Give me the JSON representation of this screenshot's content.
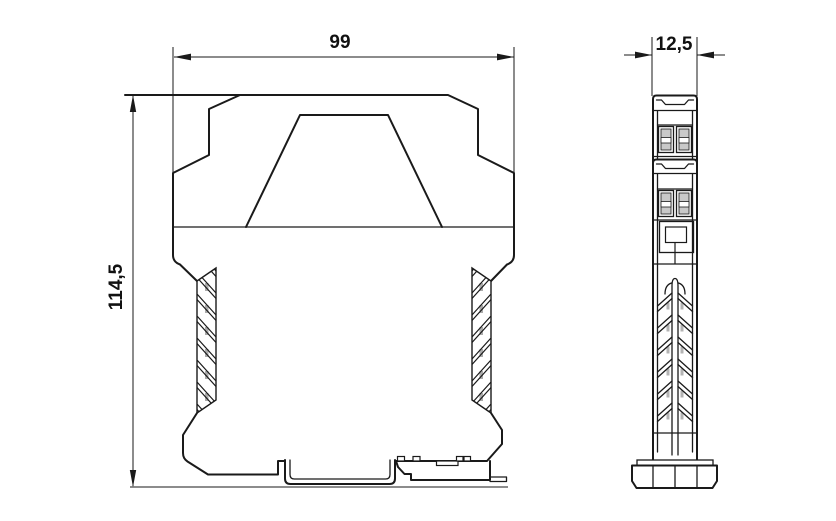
{
  "drawing": {
    "background_color": "#ffffff",
    "line_color": "#1a1a1a",
    "screw_fill_color": "#c9c9c9",
    "hatch_tick_color": "#ababab",
    "dimensions": {
      "front_width_mm": "99",
      "front_height_mm": "114,5",
      "side_width_mm": "12,5"
    }
  }
}
